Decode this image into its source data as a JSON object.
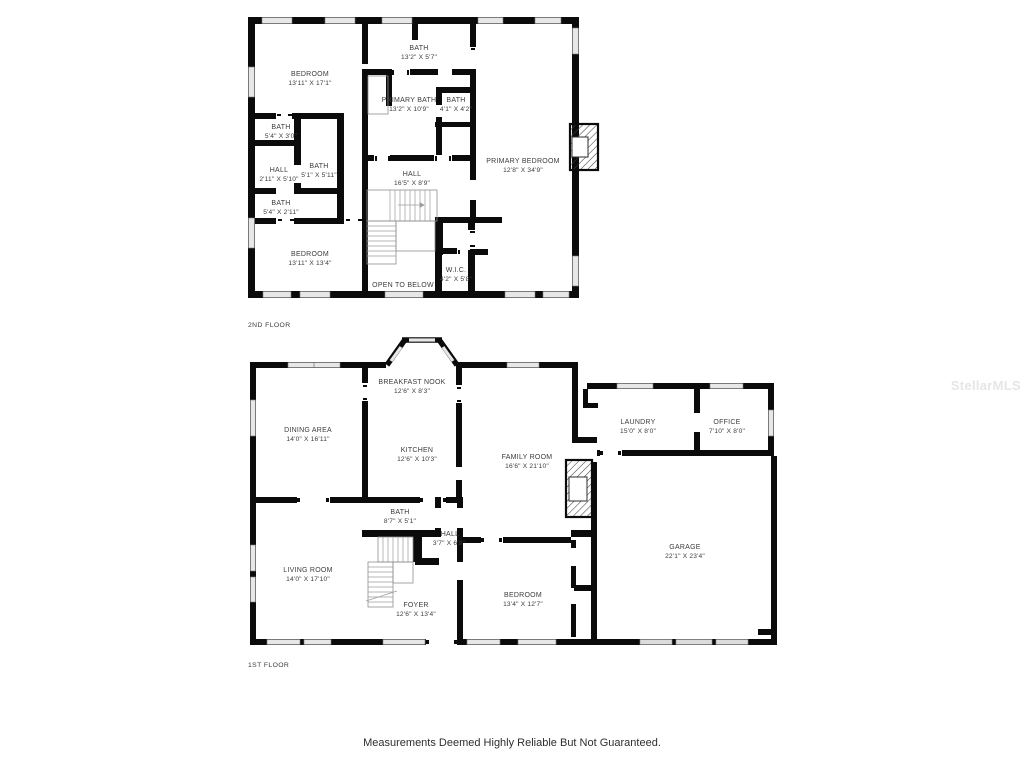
{
  "watermark": "StellarMLS",
  "disclaimer": "Measurements Deemed Highly Reliable But Not Guaranteed.",
  "floor2": {
    "label": "2ND FLOOR",
    "open_to_below": "OPEN TO BELOW",
    "rooms": {
      "bedroom_top": {
        "name": "BEDROOM",
        "dims": "13'11\" X 17'1\""
      },
      "bath_top": {
        "name": "BATH",
        "dims": "13'2\" X 5'7\""
      },
      "primary_bath": {
        "name": "PRIMARY BATH",
        "dims": "13'2\" X 10'9\""
      },
      "bath_small": {
        "name": "BATH",
        "dims": "4'1\" X 4'2\""
      },
      "bath_left_upper": {
        "name": "BATH",
        "dims": "5'4\" X 3'0\""
      },
      "hall_left": {
        "name": "HALL",
        "dims": "2'11\" X 5'10\""
      },
      "bath_center": {
        "name": "BATH",
        "dims": "5'1\" X 5'11\""
      },
      "bath_left_lower": {
        "name": "BATH",
        "dims": "5'4\" X 2'11\""
      },
      "hall_main": {
        "name": "HALL",
        "dims": "16'5\" X 8'9\""
      },
      "bedroom_bottom": {
        "name": "BEDROOM",
        "dims": "13'11\" X 13'4\""
      },
      "primary_bedroom": {
        "name": "PRIMARY BEDROOM",
        "dims": "12'8\" X 34'9\""
      },
      "wic": {
        "name": "W.I.C.",
        "dims": "4'2\" X 5'8\""
      }
    }
  },
  "floor1": {
    "label": "1ST FLOOR",
    "rooms": {
      "breakfast_nook": {
        "name": "BREAKFAST NOOK",
        "dims": "12'6\" X 8'3\""
      },
      "dining_area": {
        "name": "DINING AREA",
        "dims": "14'0\" X 16'11\""
      },
      "kitchen": {
        "name": "KITCHEN",
        "dims": "12'6\" X 10'3\""
      },
      "family_room": {
        "name": "FAMILY ROOM",
        "dims": "16'6\" X 21'10\""
      },
      "laundry": {
        "name": "LAUNDRY",
        "dims": "15'0\" X 8'0\""
      },
      "office": {
        "name": "OFFICE",
        "dims": "7'10\" X 8'0\""
      },
      "garage": {
        "name": "GARAGE",
        "dims": "22'1\" X 23'4\""
      },
      "living_room": {
        "name": "LIVING ROOM",
        "dims": "14'0\" X 17'10\""
      },
      "bath": {
        "name": "BATH",
        "dims": "8'7\" X 5'1\""
      },
      "hall": {
        "name": "HALL",
        "dims": "3'7\" X 6'9\""
      },
      "foyer": {
        "name": "FOYER",
        "dims": "12'6\" X 13'4\""
      },
      "bedroom": {
        "name": "BEDROOM",
        "dims": "13'4\" X 12'7\""
      }
    }
  }
}
